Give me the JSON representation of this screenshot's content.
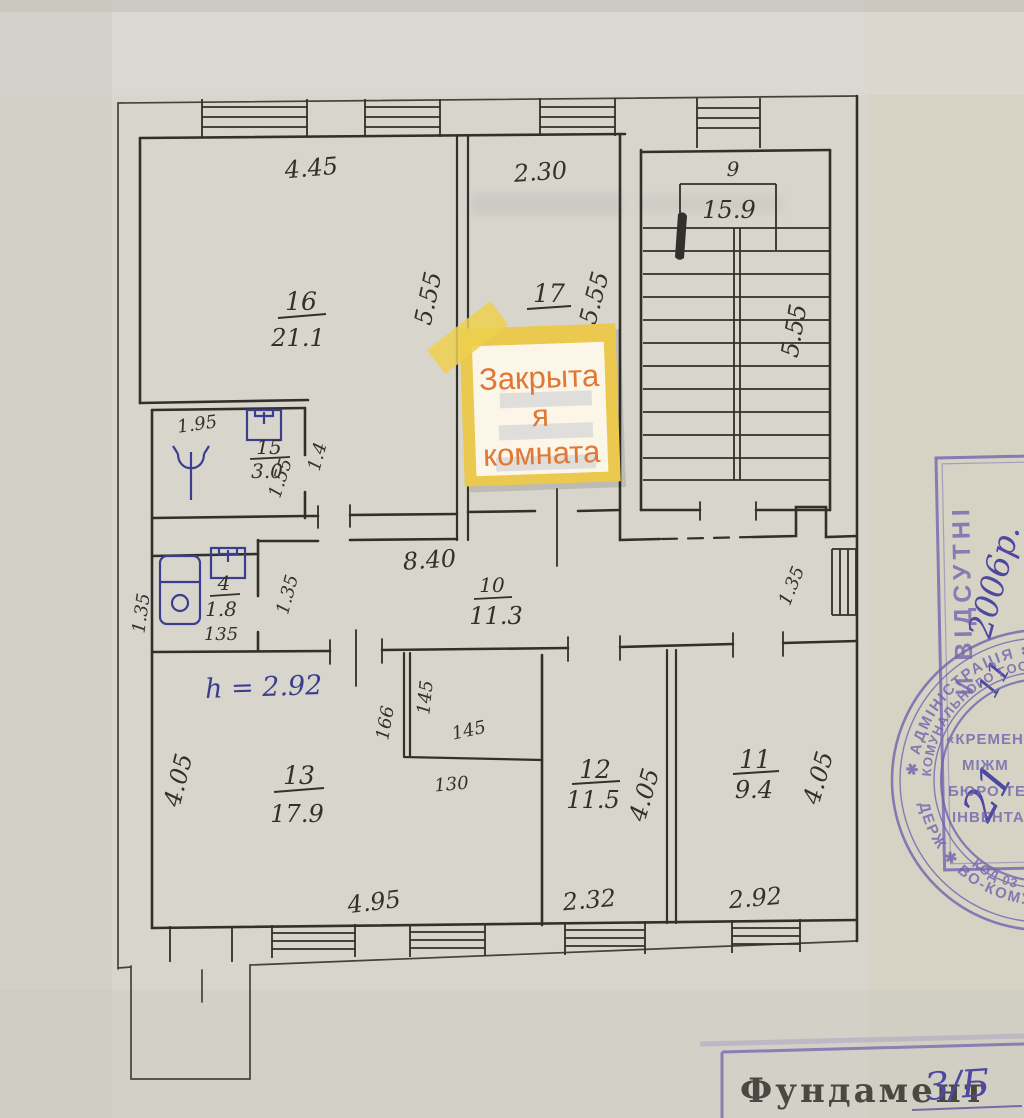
{
  "plan": {
    "rooms": {
      "r16": {
        "num": "16",
        "area": "21.1",
        "dim_top": "4.45",
        "dim_side": "5.55"
      },
      "r17": {
        "num": "17",
        "dim_top": "2.30",
        "dim_side": "5.55"
      },
      "stairs": {
        "num": "9",
        "area": "15.9",
        "dim_side": "5.55"
      },
      "r15": {
        "num": "15",
        "area": "3.0",
        "dim_top": "1.95",
        "dim_door": "1.55",
        "dim_side": "1.4"
      },
      "r4": {
        "num": "4",
        "area": "1.8",
        "dim_bottom": "135",
        "dim_left": "1.35",
        "dim_right": "1.35"
      },
      "r10": {
        "num": "10",
        "area": "11.3",
        "dim_top": "8.40",
        "dim_right": "1.35"
      },
      "r13": {
        "num": "13",
        "area": "17.9",
        "ceiling_height": "h = 2.92",
        "dim_left": "4.05",
        "dim_bottom": "4.95",
        "niche_d1": "166",
        "niche_d2": "145",
        "niche_d3": "145",
        "niche_d4": "130"
      },
      "r12": {
        "num": "12",
        "area": "11.5",
        "dim_side": "4.05",
        "dim_bottom": "2.32"
      },
      "r11": {
        "num": "11",
        "area": "9.4",
        "dim_side": "4.05",
        "dim_bottom": "2.92"
      }
    },
    "sticky_note": {
      "line1": "Закрыта",
      "line2": "я",
      "line3": "комната"
    },
    "stamps": {
      "rect_stamp": {
        "vertical_text": "И ВІДСУТНІ",
        "year": "2006р.",
        "month": "11",
        "day": "21"
      },
      "round_seal": {
        "outer_top": "✱ АДМІНІСТРАЦІЯ ✱ УК",
        "outer_bottom": "ДЕРЖ ✱ ВО-КОМУН ✱",
        "inner_top": "КОМУНАЛЬНОГО ГОСПОДАРСТВА",
        "inner_bottom": "КОД 03",
        "center1": "«КРЕМЕН",
        "center2": "МІЖМ",
        "center3": "БЮРО ТЕ",
        "center4": "ІНВЕНТАР"
      },
      "foundation": {
        "label": "Фундамент",
        "value": "З/Б"
      }
    },
    "colors": {
      "ink": "#33312b",
      "blue_ink": "#3b3e8f",
      "stamp_purple": "#6f64ae",
      "note_border": "#eac94e",
      "note_fill": "#fbf6e7",
      "note_text": "#e07734",
      "paper": "#d8d5cd"
    }
  }
}
